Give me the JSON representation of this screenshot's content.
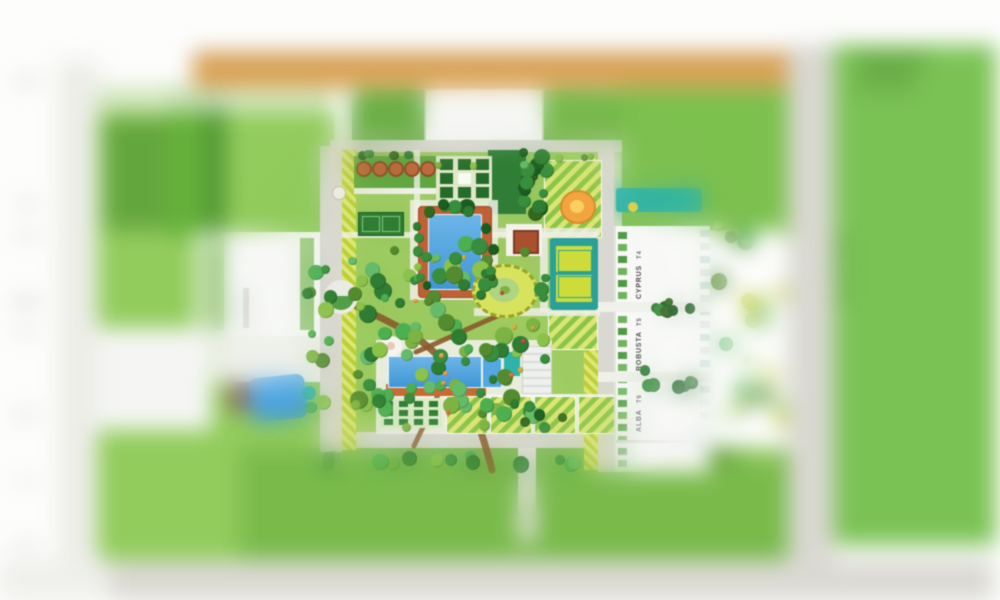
{
  "towers": [
    {
      "name": "CYPRUS",
      "unit": "T4"
    },
    {
      "name": "ROBUSTA",
      "unit": "T5"
    },
    {
      "name": "ALBA",
      "unit": "T6"
    }
  ],
  "colors": {
    "pool_blue": "#54a7e0",
    "pool_blue_deep": "#3f97d6",
    "water_teal": "#2fb3a8",
    "deck_terracotta": "#bf6134",
    "path_brown": "#8a5a2b",
    "lawn_bright": "#7cc242",
    "lawn_base": "#9ccb5f",
    "lawn_dark": "#2f7d36",
    "hedge_dark": "#256c2a",
    "stripe_yellow": "#dce775",
    "stripe_lime": "#bccf35",
    "road_gray": "#d9d8d2",
    "band_orange": "#d8a45c",
    "court_teal": "#2aa198",
    "court_yellow": "#cddc39",
    "playground_orange": "#f2a440",
    "field_green": "#7ec15a",
    "bottom_band": "#dad9d3"
  }
}
